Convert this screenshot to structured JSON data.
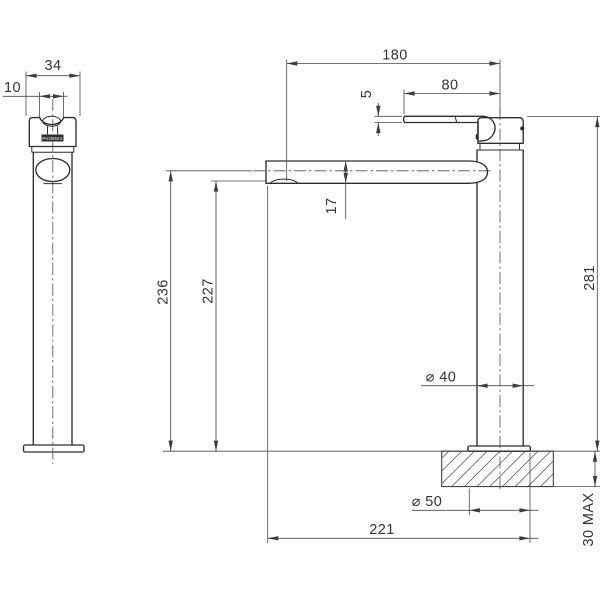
{
  "drawing": {
    "brand_label": "PHOENIX",
    "dimensions": {
      "spout_width_front": "34",
      "handle_slot_width": "10",
      "overall_projection": "180",
      "handle_length": "80",
      "handle_thickness": "5",
      "spout_tube_height": "17",
      "height_to_spout_centre": "236",
      "height_to_outlet": "227",
      "overall_height": "281",
      "body_diameter": "⌀ 40",
      "base_diameter": "⌀ 50",
      "spout_reach_overall": "221",
      "bench_thickness_max": "30 MAX"
    }
  }
}
